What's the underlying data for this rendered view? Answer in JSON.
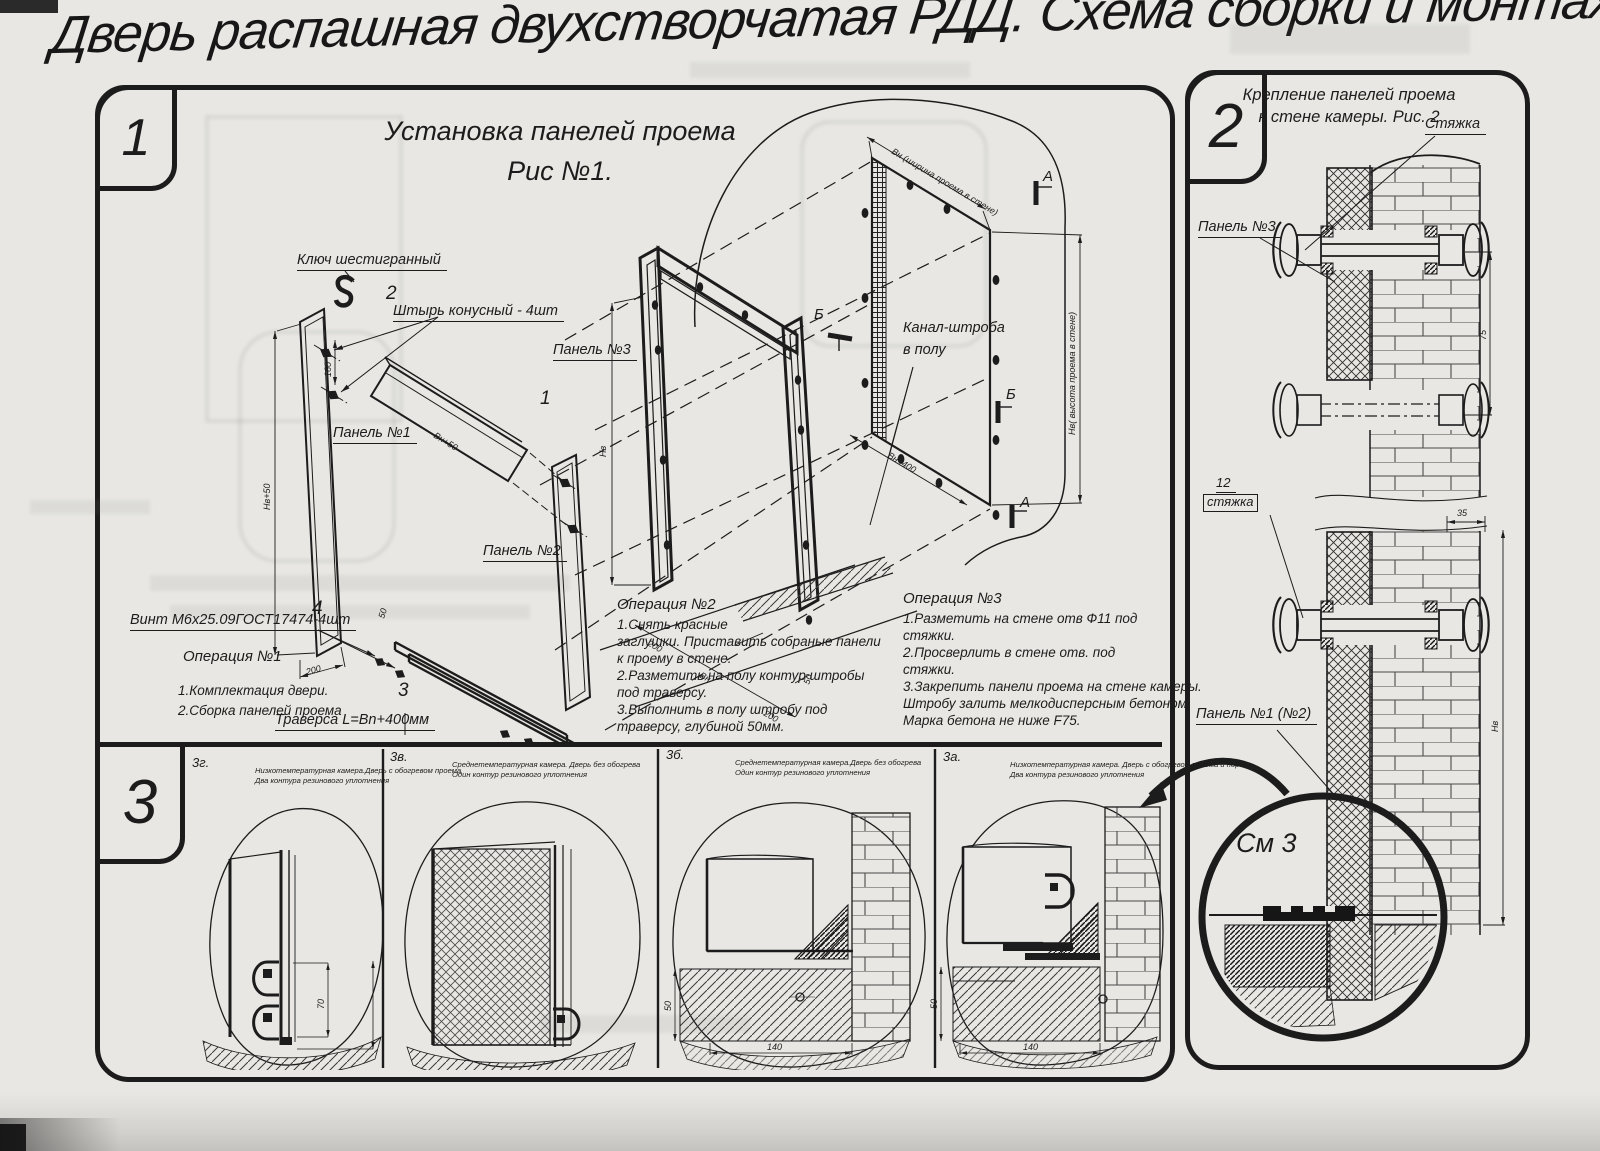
{
  "title": "Дверь распашная двухстворчатая РДД.  Схема сборки и монтажа №2",
  "fig1": {
    "badge": "1",
    "heading_line1": "Установка панелей проема",
    "heading_line2": "Рис №1.",
    "labels": {
      "hex_key": "Ключ шестигранный",
      "pin_num": "2",
      "pin": "Штырь конусный - 4шт",
      "panel3": "Панель №3",
      "panel3_num": "1",
      "panel1": "Панель №1",
      "panel2": "Панель №2",
      "screw_num": "4",
      "screw": "Винт М6х25.09ГОСТ17474-4шт",
      "traverse_num": "3",
      "traverse": "Траверса  L=Bn+400мм",
      "channel_line1": "Канал-штроба",
      "channel_line2": "в полу",
      "marker_a": "А",
      "marker_b": "Б"
    },
    "dims": {
      "nv50": "Нв+50",
      "d160": "160",
      "d200": "200",
      "vn50": "Вн+50",
      "d50": "50",
      "nv": "Нв",
      "vn": "Вн",
      "vn400": "Вн+400",
      "opening_width": "Вн (ширина проема в стене)",
      "opening_height": "Нв( высота проема в стене)"
    },
    "op1": {
      "title": "Операция №1",
      "lines": [
        "1.Комплектация двери.",
        "2.Сборка панелей проема"
      ]
    },
    "op2": {
      "title": "Операция №2",
      "lines": [
        "1.Снять красные",
        "заглушки. Приставить собраные панели",
        "к проему в стене.",
        "2.Разметить на полу контур штробы",
        "под траверсу.",
        "3.Выполнить в полу штробу под",
        "траверсу, глубиной 50мм."
      ]
    },
    "op3": {
      "title": "Операция №3",
      "lines": [
        "1.Разметить на стене отв Ф11 под",
        "стяжки.",
        "2.Просверлить в стене отв.    под",
        "стяжки.",
        "3.Закрепить панели проема на стене камеры.",
        "Штробу залить мелкодисперсным бетоном",
        "Марка бетона не ниже   F75."
      ]
    }
  },
  "fig2": {
    "badge": "2",
    "heading_line1": "Крепление панелей проема",
    "heading_line2": "к стене камеры. Рис. 2",
    "labels": {
      "tie": "Стяжка",
      "panel3": "Панель №3",
      "tie_num": "12",
      "tie_boxed": "стяжка",
      "panel12": "Панель №1 (№2)",
      "see3": "См 3"
    },
    "dims": {
      "d75": "75",
      "d35": "35",
      "nv": "Нв"
    }
  },
  "fig3": {
    "badge": "3",
    "items": [
      {
        "code": "3г.",
        "caption_line1": "Низкотемпературная камера.Дверь с обогревом проема",
        "caption_line2": "Два контура резинового уплотнения"
      },
      {
        "code": "3в.",
        "caption_line1": "Среднетемпературная камера. Дверь без обогрева",
        "caption_line2": "Один контур резинового уплотнения"
      },
      {
        "code": "3б.",
        "caption_line1": "Среднетемпературная камера.Дверь без обогрева",
        "caption_line2": "Один контур резинового уплотнения"
      },
      {
        "code": "3а.",
        "caption_line1": "Низкотемпературная камера. Дверь с обогревом проема и порога",
        "caption_line2": "Два контура резинового уплотнения"
      }
    ],
    "dims": {
      "d70": "70",
      "d140": "140",
      "d50": "50"
    }
  }
}
